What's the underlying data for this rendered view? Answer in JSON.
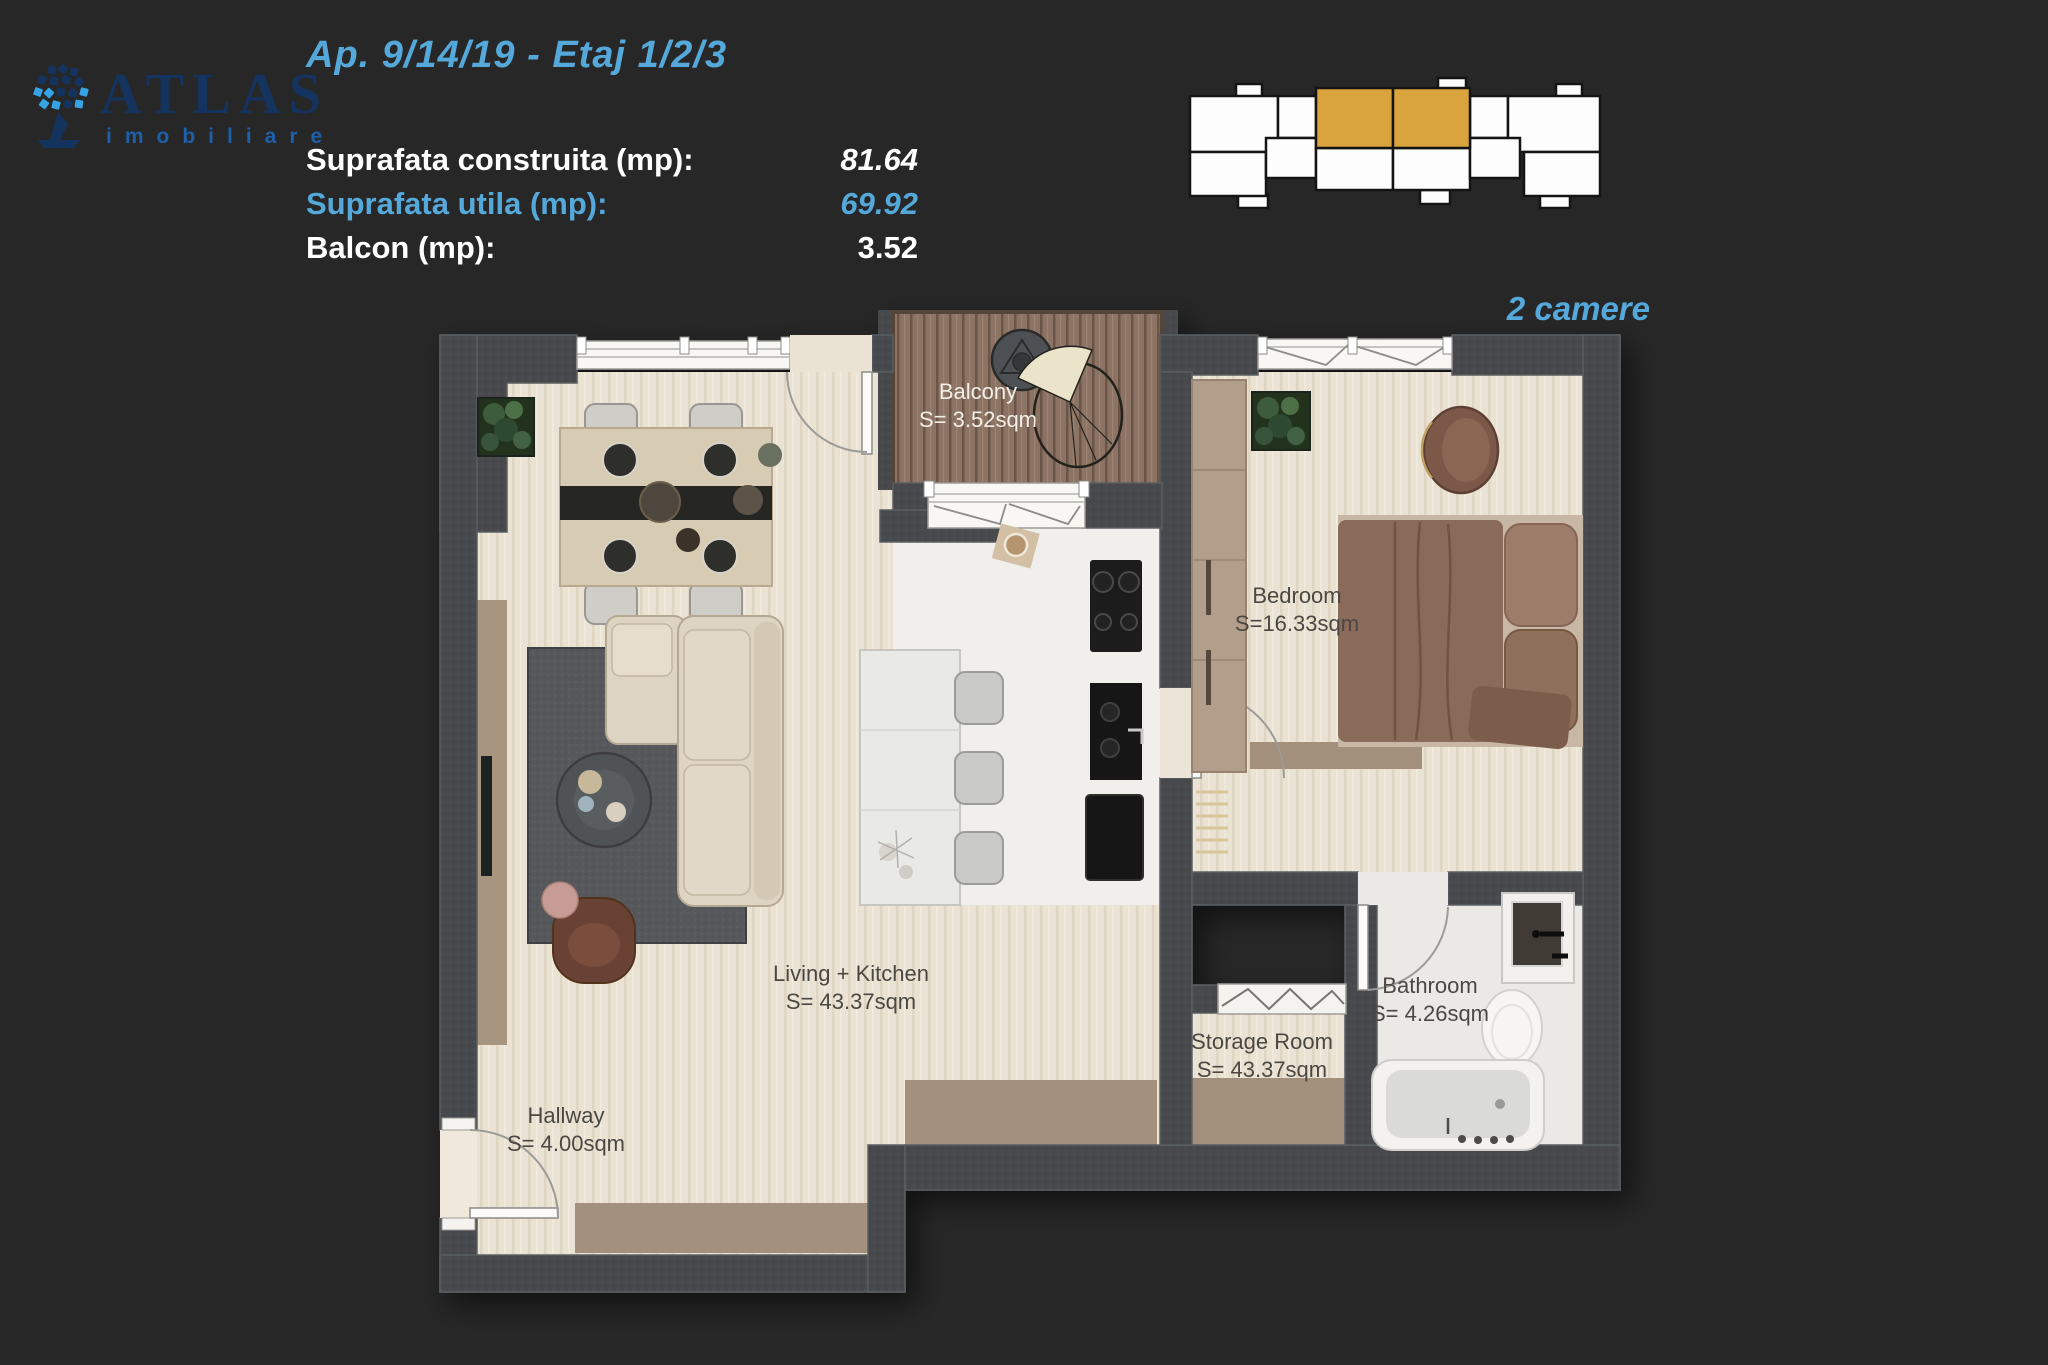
{
  "header": {
    "logo": {
      "text": "ATLAS",
      "subtitle": "imobiliare",
      "icon": "atlas-globe-icon"
    },
    "title": "Ap. 9/14/19 - Etaj 1/2/3",
    "stats": [
      {
        "label": "Suprafata construita (mp):",
        "value": "81.64"
      },
      {
        "label": "Suprafata utila (mp):",
        "value": "69.92"
      },
      {
        "label": "Balcon (mp):",
        "value": "3.52"
      }
    ],
    "apartment_type": "2 camere"
  },
  "key_plan": {
    "description": "building-overview-with-highlighted-units",
    "highlighted_units": 2,
    "highlight_color": "#d9a33d",
    "unit_color": "#fdfdfd",
    "outline_color": "#141414"
  },
  "colors": {
    "accent_blue": "#55a9da",
    "highlight_gold": "#d9a33d",
    "background": "#272727",
    "navy_logo": "#14335e",
    "logo_sub_blue": "#1d5fa8",
    "wall": "#46494d",
    "wood_floor": "#eae2d3",
    "deck_wood": "#8c7363",
    "marble_floor": "#f0efec",
    "rug": "#56585c"
  },
  "rooms": [
    {
      "id": "balcony",
      "name": "Balcony",
      "area": "S= 3.52sqm"
    },
    {
      "id": "bedroom",
      "name": "Bedroom",
      "area": "S=16.33sqm"
    },
    {
      "id": "living_kitchen",
      "name": "Living + Kitchen",
      "area": "S= 43.37sqm"
    },
    {
      "id": "hallway",
      "name": "Hallway",
      "area": "S= 4.00sqm"
    },
    {
      "id": "storage",
      "name": "Storage Room",
      "area": "S= 43.37sqm"
    },
    {
      "id": "bathroom",
      "name": "Bathroom",
      "area": "S= 4.26sqm"
    }
  ]
}
